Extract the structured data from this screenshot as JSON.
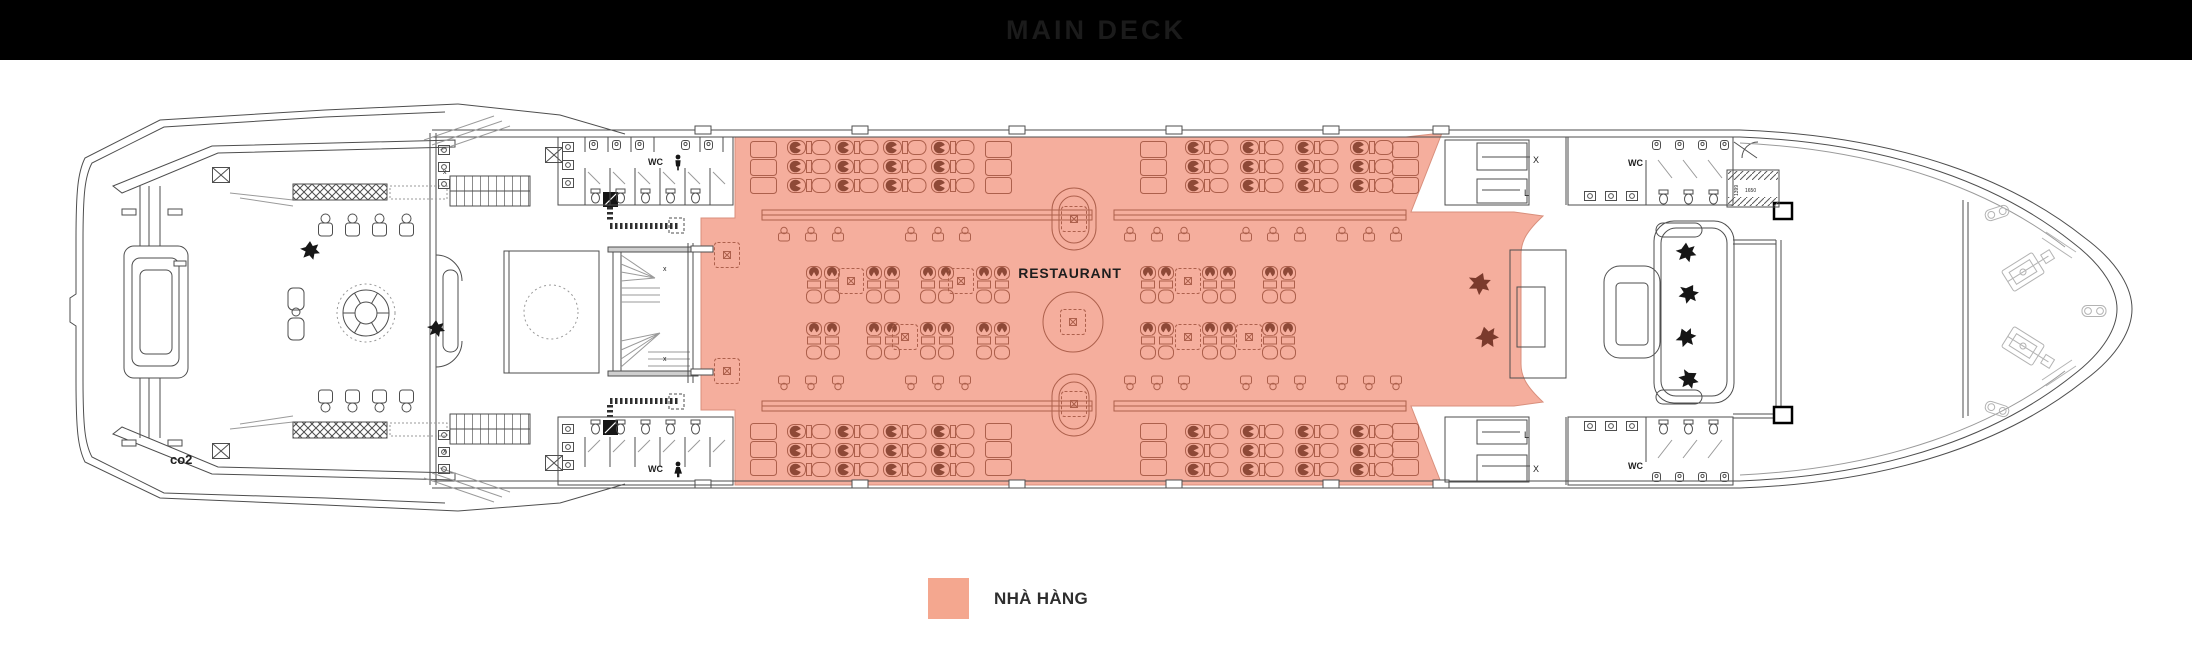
{
  "header": {
    "title": "MAIN DECK",
    "bg_color": "#000000",
    "text_color": "#1b1b1b"
  },
  "plan": {
    "restaurant_label": "RESTAURANT",
    "wc_label": "WC",
    "co2_label": "co2",
    "stair_label_x": "X",
    "stair_label_l": "L",
    "stair_label_x_small": "x",
    "dim_label_a": "1650",
    "dim_label_b": "1399",
    "colors": {
      "zone_fill": "#F5AE9D",
      "zone_line": "#AD604C",
      "chair_dark": "#8E4937",
      "plant_brown": "#7B3A2C",
      "plant_black": "#161616",
      "line": "#4E4E4E",
      "equipment": "#B3B3B3"
    }
  },
  "legend": {
    "label": "NHÀ HÀNG",
    "swatch_color": "#F4A78F"
  }
}
